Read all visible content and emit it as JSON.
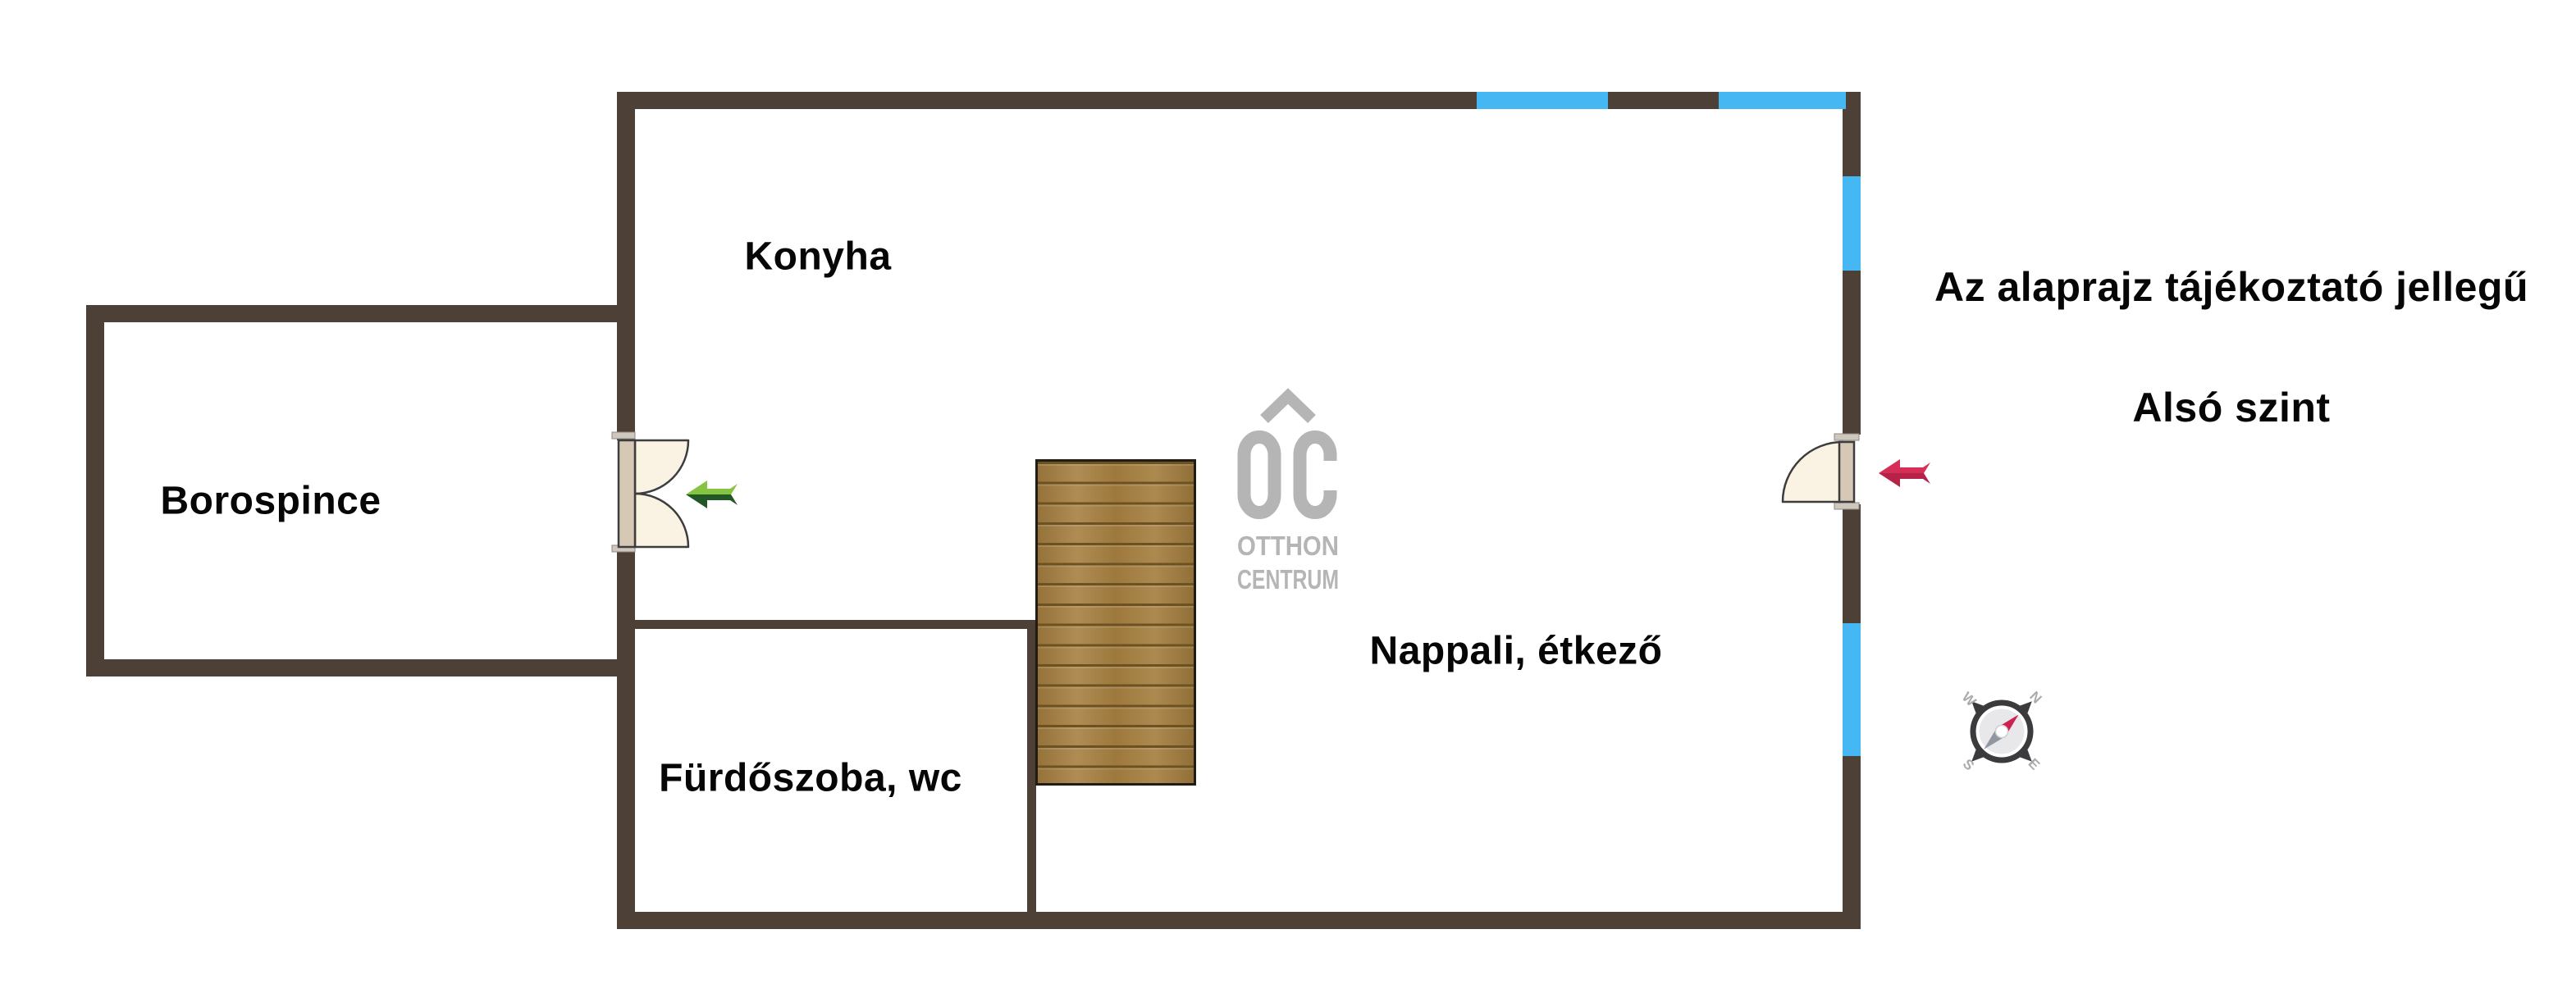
{
  "rooms": [
    {
      "label": "Konyha"
    },
    {
      "label": "Borospince"
    },
    {
      "label": "Fürdőszoba, wc"
    },
    {
      "label": "Nappali, étkező"
    }
  ],
  "notes": {
    "disclaimer": "Az alaprajz tájékoztató jellegű",
    "level": "Alsó szint"
  },
  "logo": {
    "monogram": "OC",
    "line1": "OTTHON",
    "line2": "CENTRUM"
  },
  "compass": {
    "north": "N",
    "east": "E",
    "south": "S",
    "west": "W"
  },
  "colors": {
    "wall": "#4c4037",
    "window_glass": "#45b7f2",
    "stair_wood": "#a57f40",
    "stair_line": "#6d521f",
    "door_swing_fill": "#faf2e3",
    "door_leaf": "#d5c9b6",
    "door_outline": "#3d3d3d",
    "arrow_green_light": "#85c440",
    "arrow_green_dark": "#215826",
    "arrow_red_light": "#d62e56",
    "arrow_red_dark": "#b52348",
    "logo_gray": "#b5b5b5",
    "compass_dark": "#3b3b3d",
    "compass_needle_red": "#cf2150",
    "compass_needle_gray": "#9197a0",
    "text_ink": "#060606"
  }
}
